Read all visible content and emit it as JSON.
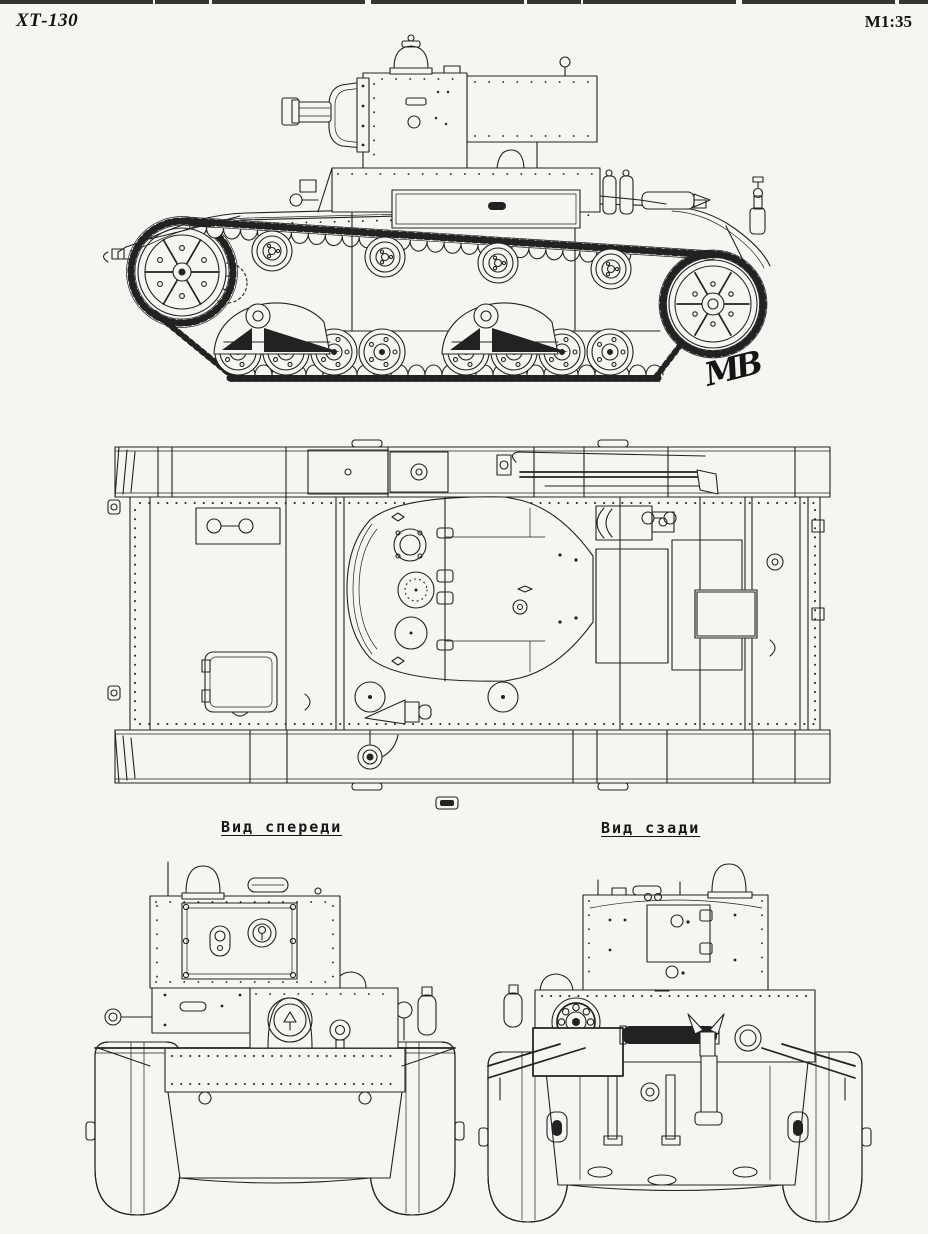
{
  "page": {
    "colors": {
      "paper": "#f6f5f1",
      "ink": "#222222"
    },
    "model": "ХТ-130",
    "scale": "M1:35",
    "signature": "МВ"
  },
  "labels": {
    "front_view": "Вид спереди",
    "rear_view": "Вид сзади"
  }
}
